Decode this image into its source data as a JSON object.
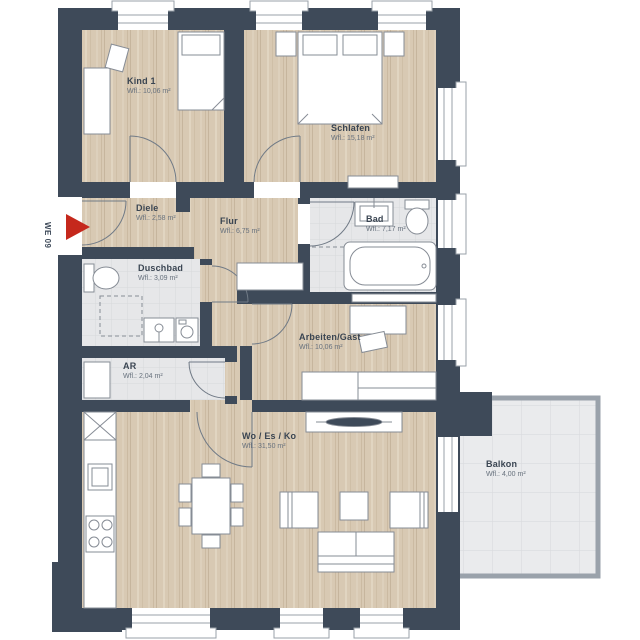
{
  "plan": {
    "title": "Wohnung Grundriss",
    "unit_label": "WE 09",
    "rooms": [
      {
        "id": "kind1",
        "name": "Kind 1",
        "area": "Wfl.: 10,06 m²",
        "x": 127,
        "y": 76
      },
      {
        "id": "schlafen",
        "name": "Schlafen",
        "area": "Wfl.: 15,18 m²",
        "x": 331,
        "y": 123
      },
      {
        "id": "diele",
        "name": "Diele",
        "area": "Wfl.: 2,58 m²",
        "x": 136,
        "y": 203
      },
      {
        "id": "flur",
        "name": "Flur",
        "area": "Wfl.: 6,75 m²",
        "x": 220,
        "y": 216
      },
      {
        "id": "bad",
        "name": "Bad",
        "area": "Wfl.: 7,17 m²",
        "x": 366,
        "y": 214
      },
      {
        "id": "duschbad",
        "name": "Duschbad",
        "area": "Wfl.: 3,09 m²",
        "x": 138,
        "y": 263
      },
      {
        "id": "ar",
        "name": "AR",
        "area": "Wfl.: 2,04 m²",
        "x": 123,
        "y": 361
      },
      {
        "id": "arbeiten",
        "name": "Arbeiten/Gast",
        "area": "Wfl.: 10,06 m²",
        "x": 299,
        "y": 332
      },
      {
        "id": "woesko",
        "name": "Wo / Es / Ko",
        "area": "Wfl.: 31,50 m²",
        "x": 242,
        "y": 431
      },
      {
        "id": "balkon",
        "name": "Balkon",
        "area": "Wfl.: 4,00 m²",
        "x": 486,
        "y": 459
      }
    ],
    "colors": {
      "wall": "#3e4a59",
      "wood": "#d8c9b3",
      "tile": "#e6e7e9",
      "balcony_tile": "#eaebed",
      "furniture_stroke": "#868c95",
      "accent_red": "#c5281c",
      "text": "#3a4552"
    }
  }
}
